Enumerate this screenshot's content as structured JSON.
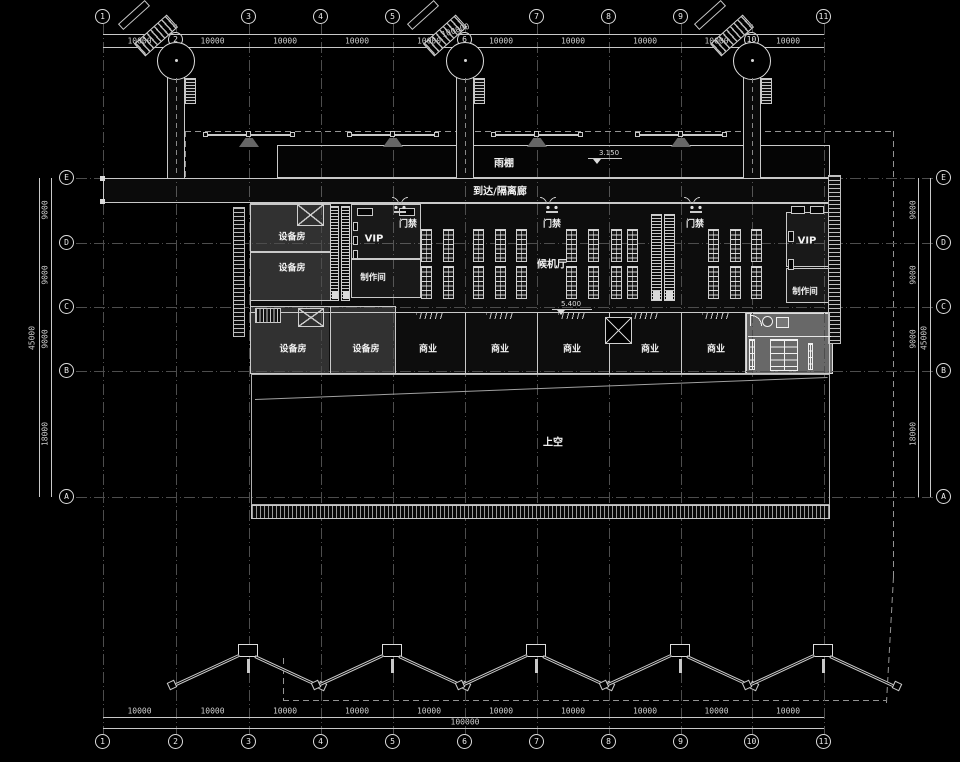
{
  "drawing": {
    "floor_labels": {
      "canopy": "雨棚",
      "arrival_corridor": "到达/隔离廊",
      "gate": "门禁",
      "vip": "VIP",
      "production_room": "制作间",
      "equipment_room": "设备房",
      "waiting_hall": "候机厅",
      "commercial": "商业",
      "void_above": "上空"
    },
    "elevations": {
      "canopy": "3.150",
      "hall": "5.400"
    },
    "grid": {
      "top_bubbles": [
        "1",
        "3",
        "4",
        "5",
        "7",
        "8",
        "9",
        "11"
      ],
      "mid_bubbles": [
        "2",
        "6",
        "10"
      ],
      "bottom_bubbles": [
        "1",
        "2",
        "3",
        "4",
        "5",
        "6",
        "7",
        "8",
        "9",
        "10",
        "11"
      ],
      "side_bubbles": [
        "E",
        "D",
        "C",
        "B",
        "A"
      ]
    },
    "dims": {
      "top": [
        "10000",
        "10000",
        "10000",
        "10000",
        "10000",
        "10000",
        "10000",
        "10000",
        "10000",
        "10000"
      ],
      "bottom": [
        "10000",
        "10000",
        "10000",
        "10000",
        "10000",
        "10000",
        "10000",
        "10000",
        "10000",
        "10000"
      ],
      "left": [
        "9000",
        "9000",
        "9000",
        "18000"
      ],
      "right": [
        "9000",
        "9000",
        "9000",
        "18000"
      ],
      "total_width": "100000",
      "total_height": "45000"
    }
  }
}
